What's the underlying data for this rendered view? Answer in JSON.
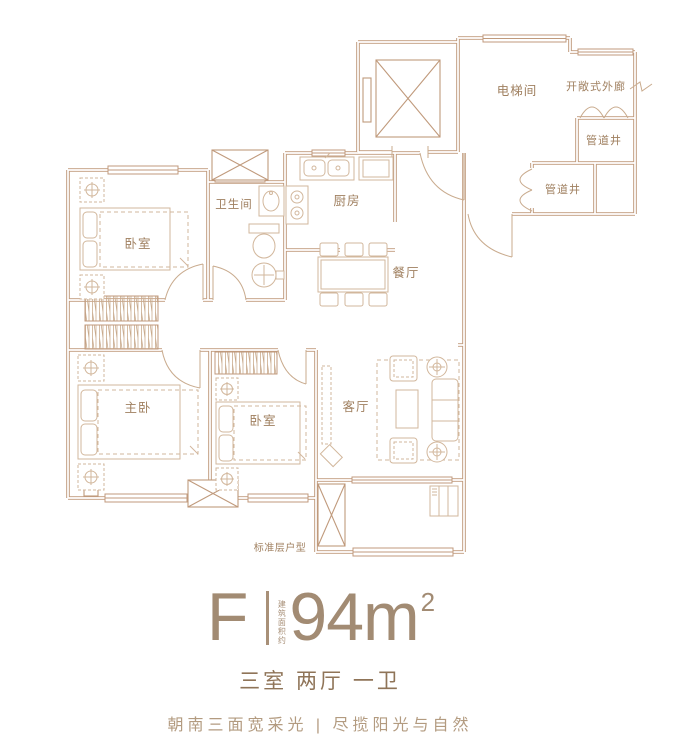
{
  "plan": {
    "rooms": {
      "bedroom_top": "卧室",
      "bathroom": "卫生间",
      "kitchen": "厨房",
      "dining": "餐厅",
      "elevator_hall": "电梯间",
      "open_corridor": "开敞式外廊",
      "pipe_shaft_1": "管道井",
      "pipe_shaft_2": "管道井",
      "master_bedroom": "主卧",
      "bedroom_second": "卧室",
      "living": "客厅"
    },
    "caption": "标准层户型"
  },
  "info": {
    "unit_code": "F",
    "area_note": "建筑面积约",
    "area_value": "94m",
    "area_sup": "2",
    "layout_summary": "三室 两厅 一卫",
    "tagline": "朝南三面宽采光 | 尽揽阳光与自然"
  },
  "colors": {
    "wall_line": "#c09a7c",
    "furniture_line": "#d2b79c",
    "label_text": "#a08060",
    "headline_text": "#a28b73",
    "subtitle_text": "#8f7458",
    "tagline_text": "#b39b80"
  }
}
